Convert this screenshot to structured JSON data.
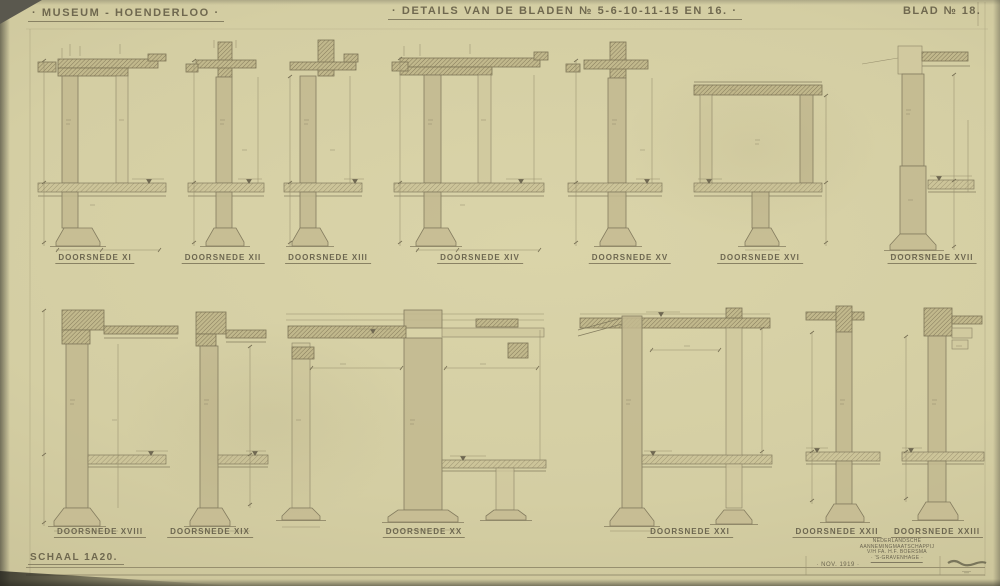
{
  "sheet": {
    "title_left": "· MUSEUM - HOENDERLOO ·",
    "title_center": "· DETAILS VAN DE BLADEN № 5-6-10-11-15 EN 16. ·",
    "sheet_number": "BLAD № 18.",
    "scale_label": "SCHAAL 1A20.",
    "date_label": "· NOV. 1919 ·"
  },
  "stamp": {
    "line1": "NEDERLANDSCHE",
    "line2": "AANNEMINGMAATSCHAPPIJ",
    "line3": "V/H FA. H.F. BOERSMA",
    "line4": "· 'S-GRAVENHAGE ·"
  },
  "captions": {
    "row1": [
      "DOORSNEDE XI",
      "DOORSNEDE XII",
      "DOORSNEDE XIII",
      "DOORSNEDE XIV",
      "DOORSNEDE XV",
      "DOORSNEDE XVI",
      "DOORSNEDE XVII"
    ],
    "row2": [
      "DOORSNEDE XVIII",
      "DOORSNEDE XIX",
      "DOORSNEDE XX",
      "DOORSNEDE XXI",
      "DOORSNEDE XXII",
      "DOORSNEDE XXIII"
    ]
  },
  "colors": {
    "paper": "#d4cea3",
    "line": "#847c5f",
    "wall_fill": "#c2b88f",
    "text": "#6c6650",
    "photo_edge": "#55544a"
  }
}
